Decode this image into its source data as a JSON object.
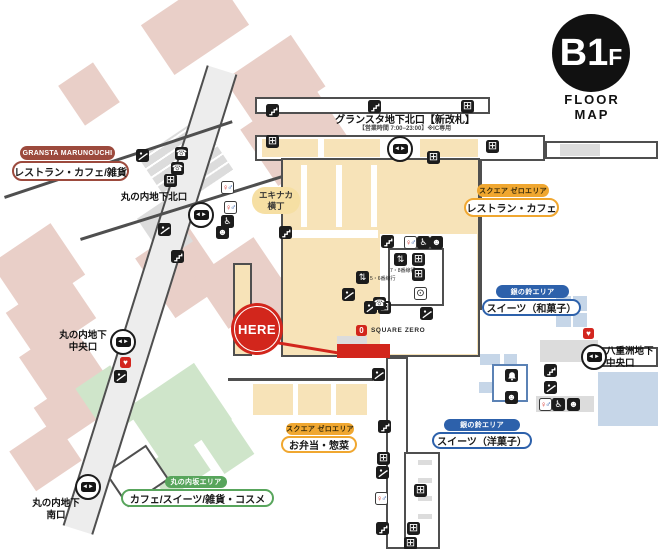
{
  "floor_badge": {
    "main": "B1",
    "suffix": "F",
    "caption": "FLOOR MAP"
  },
  "area_labels": {
    "gransta_marunouchi": {
      "tag": "GRANSTA MARUNOUCHI",
      "category": "レストラン・カフェ/雑貨"
    },
    "square_zero_east": {
      "tag": "スクエア ゼロエリア",
      "category": "レストラン・カフェ"
    },
    "square_zero_south": {
      "tag": "スクエア ゼロエリア",
      "category": "お弁当・惣菜"
    },
    "ginno_suzu_east": {
      "tag": "銀の鈴エリア",
      "category": "スイーツ（和菓子）"
    },
    "ginno_suzu_south": {
      "tag": "銀の鈴エリア",
      "category": "スイーツ（洋菓子）"
    },
    "marunouchi_zaka": {
      "tag": "丸の内坂エリア",
      "category": "カフェ/スイーツ/雑貨・コスメ"
    },
    "ekinaka_yokocho": {
      "line1": "エキナカ",
      "line2": "横丁"
    }
  },
  "exits": {
    "gransta_north": {
      "name": "グランスタ地下北口【新改札】",
      "note": "【営業時間 7:00−23:00】※IC専用"
    },
    "marunouchi_north": {
      "name": "丸の内地下北口"
    },
    "marunouchi_central": {
      "line1": "丸の内地下",
      "line2": "中央口"
    },
    "marunouchi_south": {
      "line1": "丸の内地下",
      "line2": "南口"
    },
    "yaesu_central": {
      "line1": "八重洲地下",
      "line2": "中央口"
    }
  },
  "markers": {
    "here": "HERE",
    "square_zero_logo": "SQUARE ZERO",
    "square_zero_logo_glyph": "0",
    "elevator_5_6": "5・6番線行",
    "elevator_7_8": "7・8番線行"
  },
  "icons": {
    "locker": "⊞",
    "toilet_female": "♀",
    "toilet_male": "♂",
    "accessible": "♿",
    "baby": "☻",
    "phone": "☎",
    "clock": "⊙",
    "aed": "♥",
    "elevator": "⇅",
    "gate": "◄►"
  },
  "colors": {
    "marunouchi_red": "#9c4a3d",
    "square_zero_orange": "#f0a730",
    "ginno_suzu_blue": "#2d61ab",
    "marunouchi_zaka_green": "#58a55c",
    "here_red": "#d2261c",
    "pink_block": "#e9cfc8",
    "cream_block": "#f7e3b8",
    "blue_block": "#c6d6e8",
    "green_block": "#cfe5ca"
  }
}
